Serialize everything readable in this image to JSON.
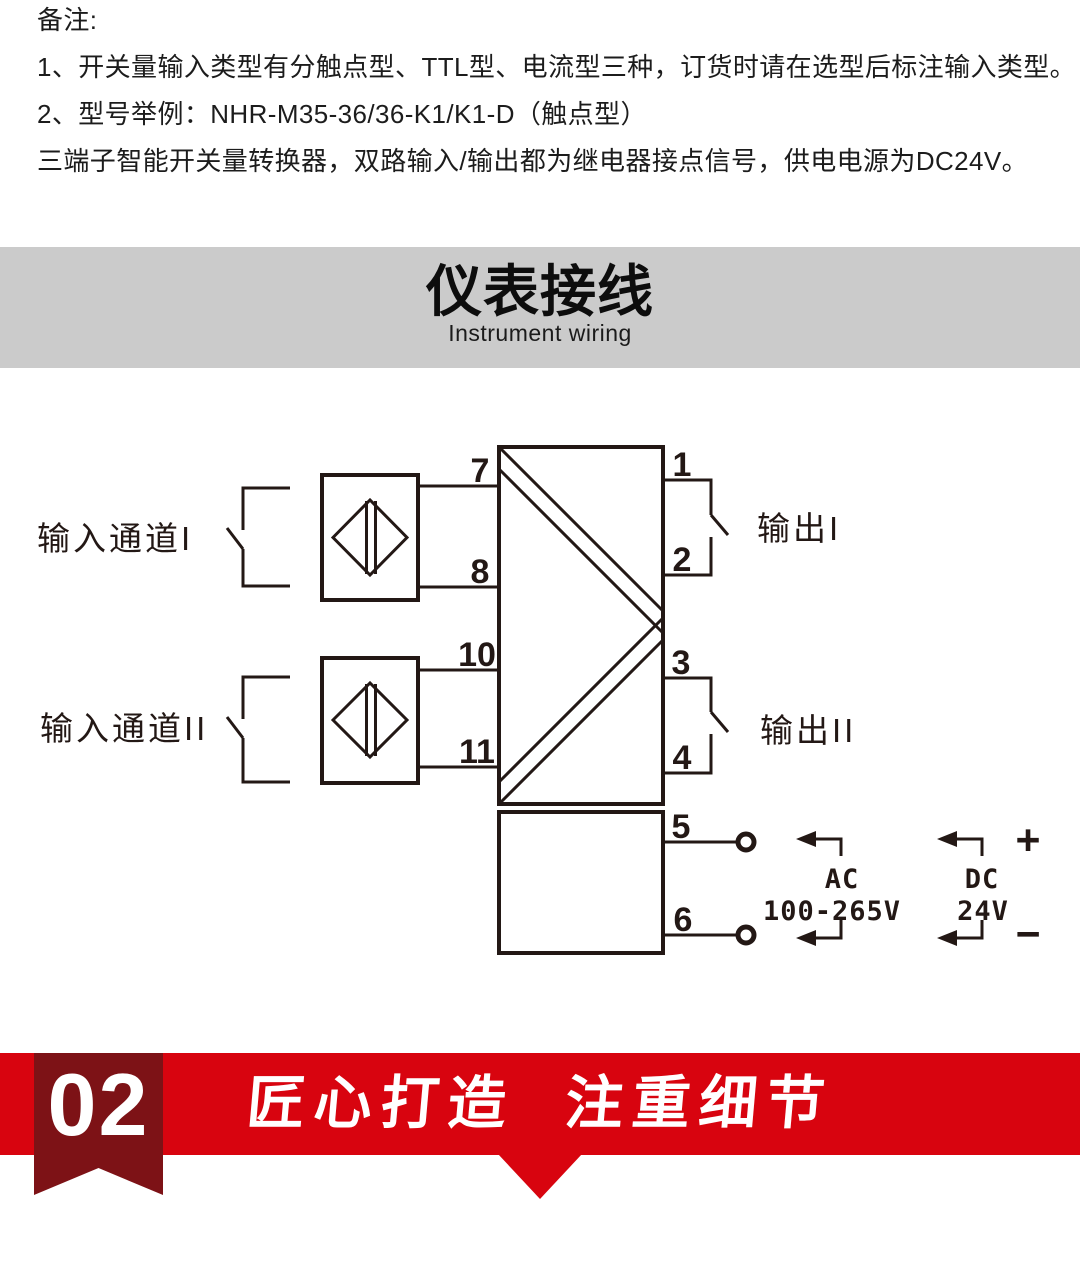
{
  "notes": {
    "title": "备注:",
    "item1": "1、开关量输入类型有分触点型、TTL型、电流型三种，订货时请在选型后标注输入类型。",
    "item2": "2、型号举例：NHR-M35-36/36-K1/K1-D（触点型）",
    "item3": "三端子智能开关量转换器，双路输入/输出都为继电器接点信号，供电电源为DC24V。"
  },
  "banner": {
    "title": "仪表接线",
    "subtitle": "Instrument wiring",
    "bg_color": "#cbcbcb"
  },
  "wiring": {
    "labels": {
      "input_channel_1": "输入通道I",
      "input_channel_2": "输入通道II",
      "output_1": "输出I",
      "output_2": "输出II"
    },
    "terminals": {
      "t1": "1",
      "t2": "2",
      "t3": "3",
      "t4": "4",
      "t5": "5",
      "t6": "6",
      "t7": "7",
      "t8": "8",
      "t10": "10",
      "t11": "11"
    },
    "power": {
      "ac": "AC",
      "ac_range": "100-265V",
      "dc": "DC",
      "dc_voltage": "24V",
      "positive": "+",
      "negative": "−"
    },
    "line_color": "#231815"
  },
  "footer": {
    "badge_number": "02",
    "title": "匠心打造  注重细节",
    "band_color": "#d8040f",
    "badge_color": "#7d1216",
    "text_color": "#ffffff"
  }
}
